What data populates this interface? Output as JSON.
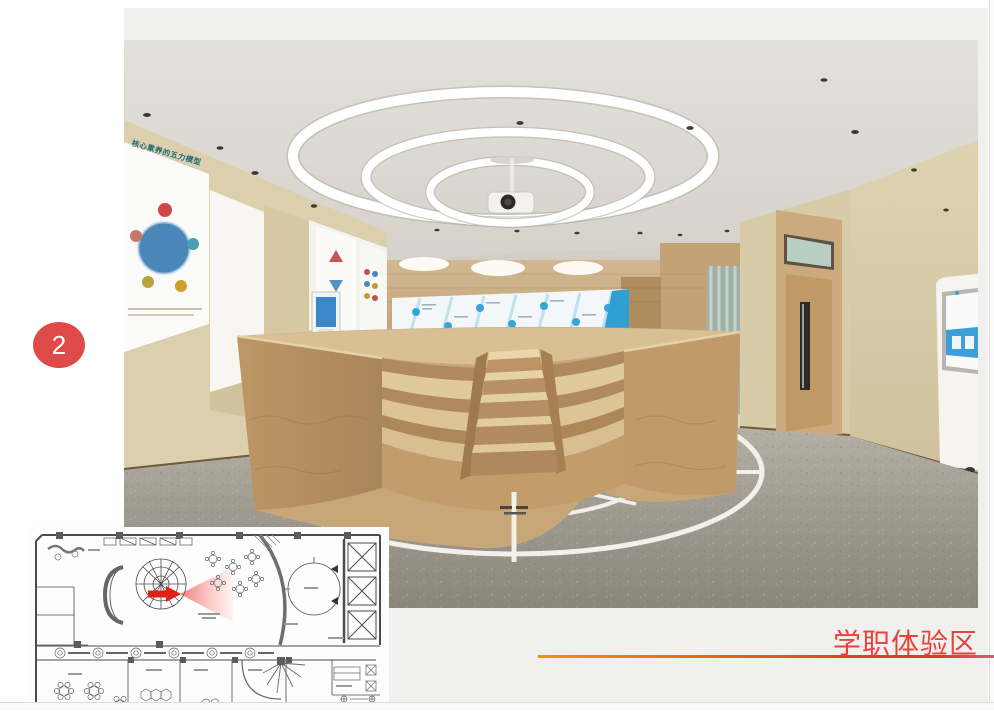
{
  "badge": {
    "number": "2"
  },
  "caption": {
    "title": "学职体验区"
  },
  "render_scene": {
    "left_poster_title": "核心素养的五力模型"
  },
  "colors": {
    "accent_red": "#e8423c",
    "badge_bg": "#e04a48",
    "underline_orange": "#f39000",
    "underline_red": "#e23530",
    "canvas_bg": "#f0f0ee",
    "timeline_blue": "#35a5d8",
    "wood": "#c9a87c"
  },
  "icons": {
    "plan_arrow": "view-direction-arrow",
    "plan_cone": "view-direction-cone"
  }
}
